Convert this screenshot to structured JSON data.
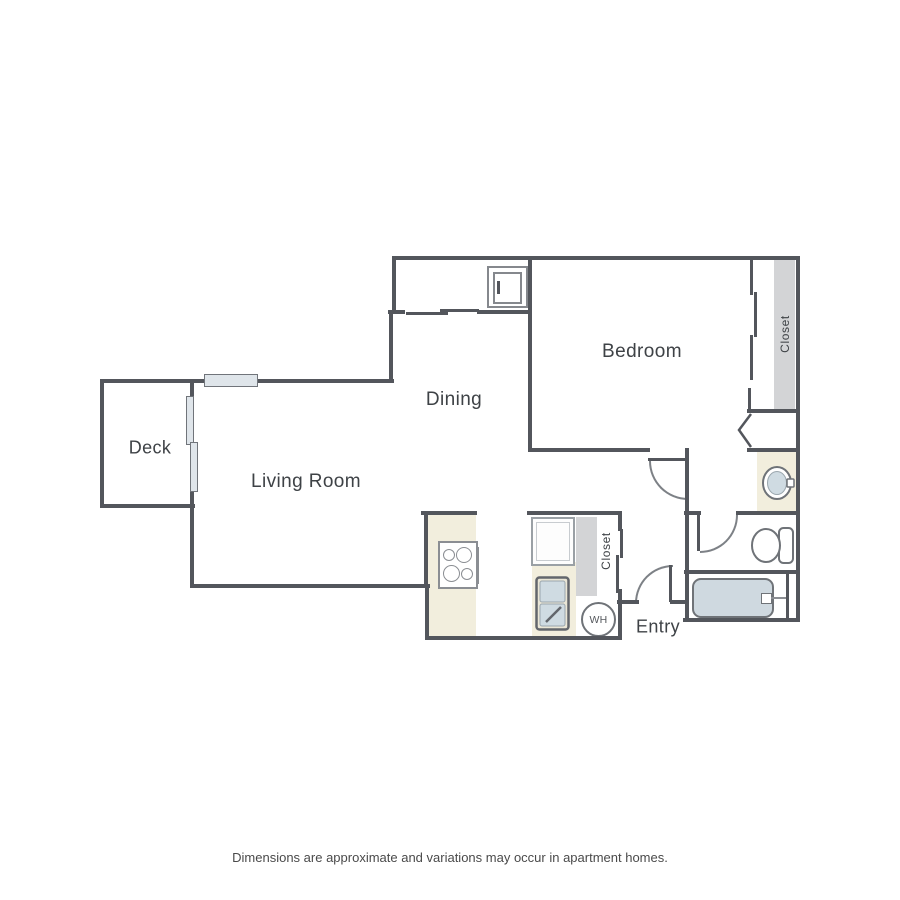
{
  "labels": {
    "bedroom": "Bedroom",
    "dining": "Dining",
    "living_room": "Living Room",
    "deck": "Deck",
    "entry": "Entry",
    "closet_bedroom": "Closet",
    "closet_entry": "Closet",
    "water_heater": "WH"
  },
  "footer": {
    "disclaimer": "Dimensions are approximate and variations may occur in apartment homes."
  },
  "colors": {
    "wall": "#53565c",
    "door": "#7d8186",
    "fixture": "#6f7378",
    "counter": "#f2eedd",
    "closet": "#d3d4d6",
    "water": "#cfd9e0",
    "glass": "#dfe5ea",
    "label": "#3e4246"
  }
}
